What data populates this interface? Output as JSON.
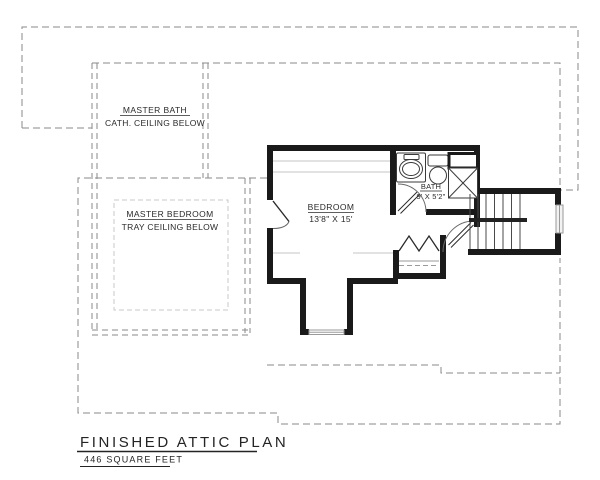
{
  "plan": {
    "rooms": {
      "master_bath": {
        "name": "MASTER BATH",
        "note": "CATH. CEILING BELOW"
      },
      "master_bedroom": {
        "name": "MASTER BEDROOM",
        "note": "TRAY CEILING BELOW"
      },
      "bedroom": {
        "name": "BEDROOM",
        "dimensions": "13'8\" X 15'"
      },
      "bath": {
        "name": "BATH",
        "dimensions": "9' X 5'2\""
      }
    },
    "title": {
      "text": "FINISHED ATTIC PLAN",
      "area": "446 SQUARE FEET"
    },
    "colors": {
      "wall": "#1a1a1a",
      "dashed_outline": "#8a8a8a",
      "light_dash": "#c9c9c9",
      "break_line": "#c4c4c4",
      "paper": "#ffffff",
      "text": "#2a2a2a"
    }
  }
}
